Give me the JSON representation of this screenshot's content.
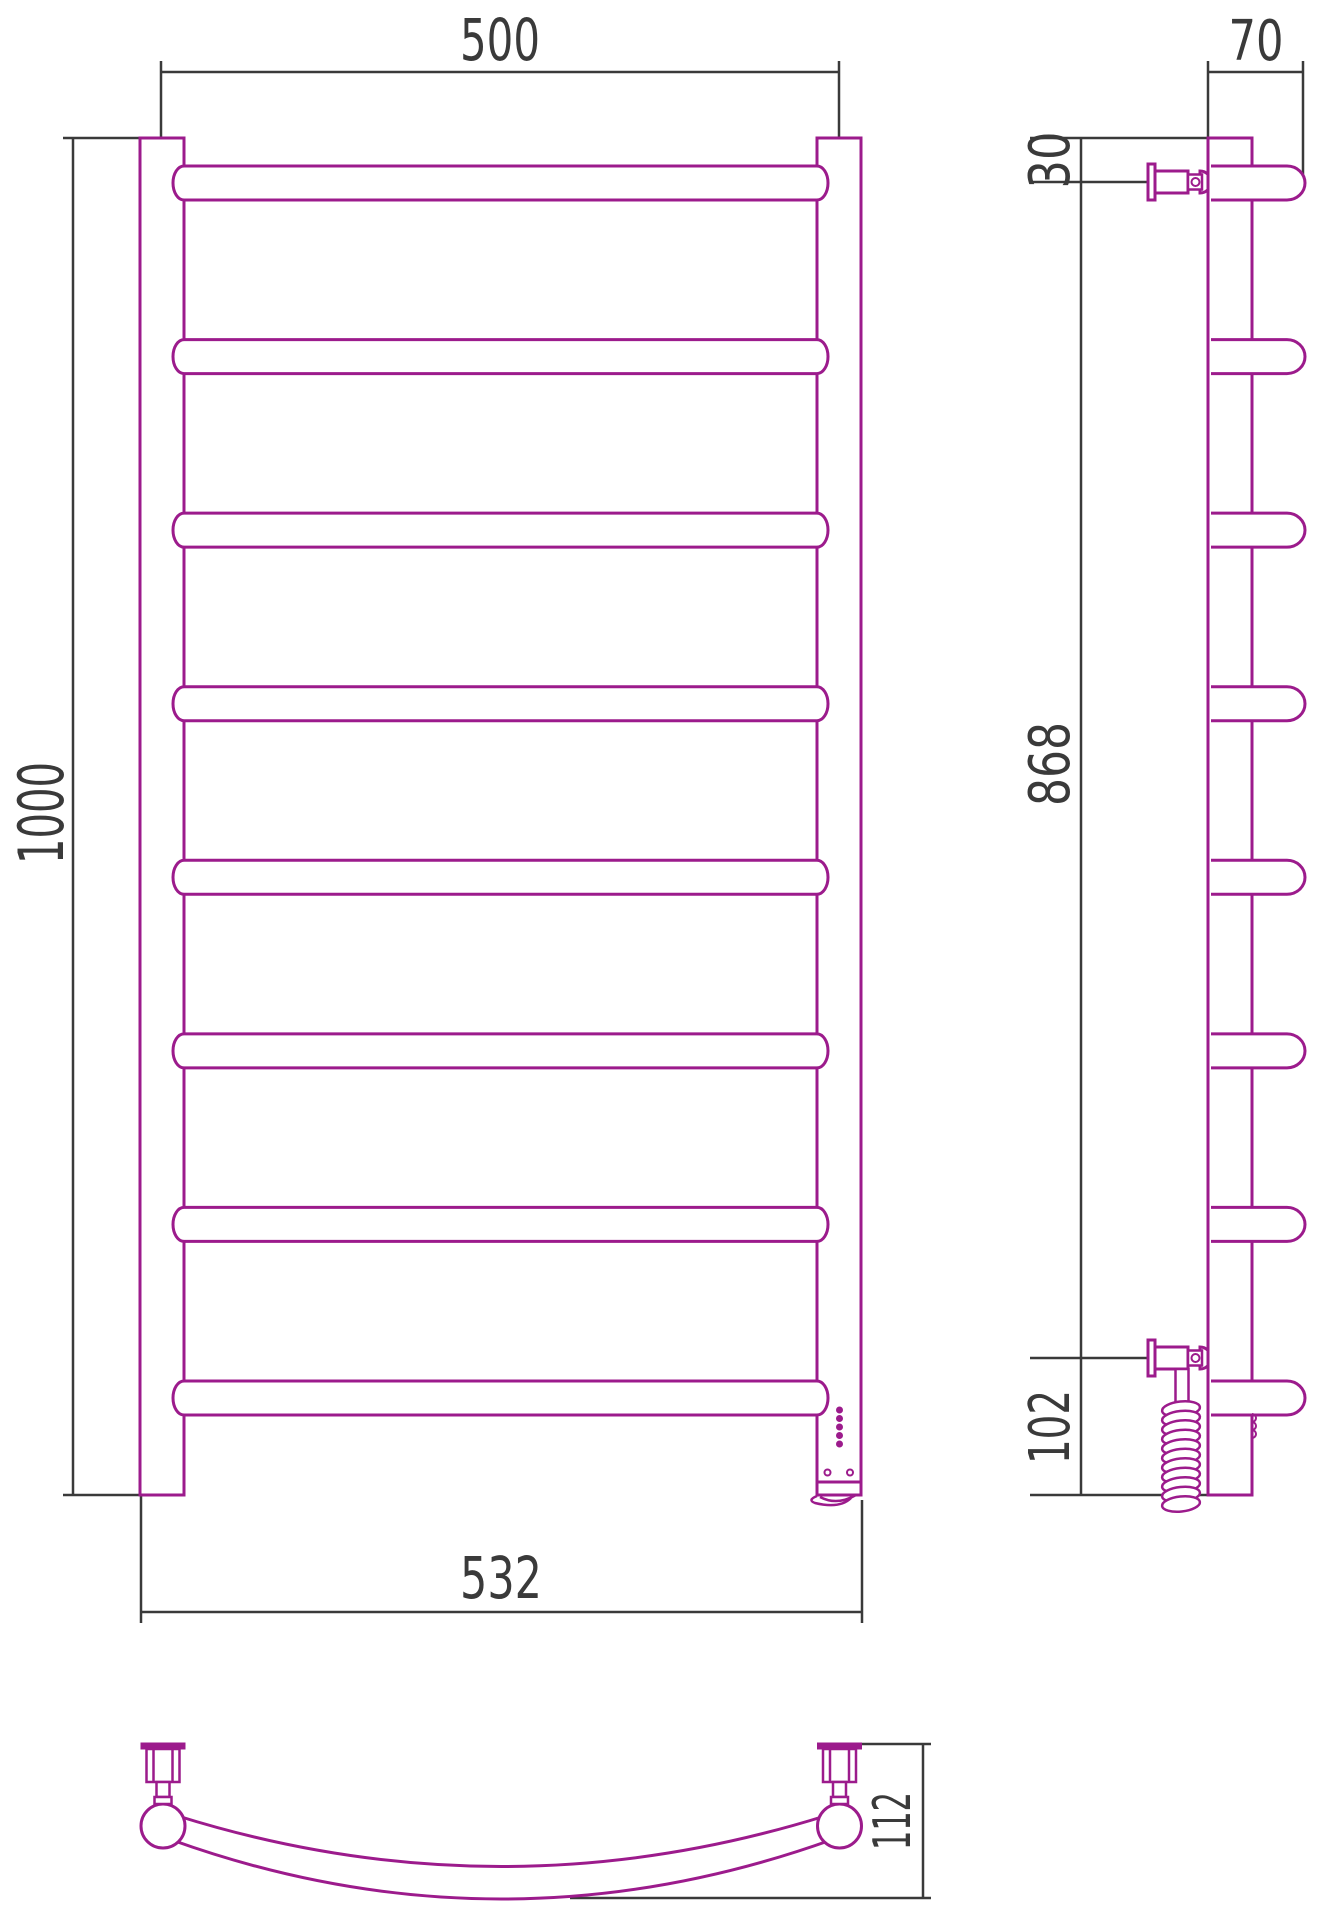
{
  "drawing": {
    "title": "Ladder towel rail — three-view dimensioned technical drawing",
    "rung_count": 8,
    "coil_turns": 11,
    "indicator_dots": 5,
    "colors": {
      "product_outline": "#9c1b8c",
      "dimension_lines": "#3a3a3a",
      "background": "#ffffff"
    },
    "views": {
      "front": {
        "width_between_rails": "500",
        "height": "1000",
        "overall_width": "532"
      },
      "side": {
        "depth": "70",
        "top_to_bracket": "30",
        "bracket_span": "868",
        "bracket_to_bottom": "102"
      },
      "bottom": {
        "mount_to_arc_depth": "112"
      }
    }
  }
}
